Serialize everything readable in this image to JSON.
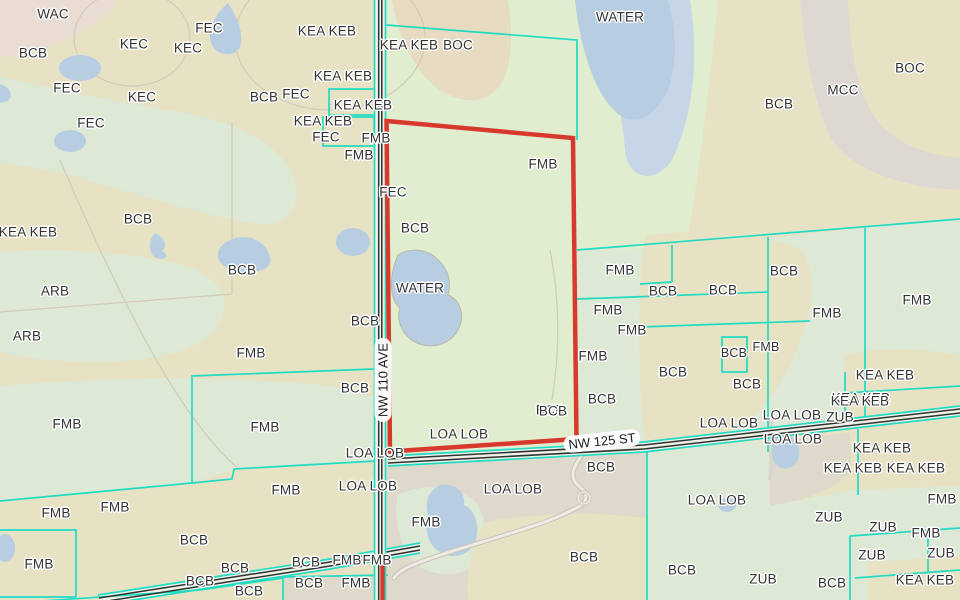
{
  "map": {
    "type": "soil-survey-map",
    "road_labels": [
      {
        "text": "NW 110 AVE",
        "x": 383,
        "y": 380,
        "rotation": -90
      },
      {
        "text": "NW 125 ST",
        "x": 602,
        "y": 441,
        "rotation": -6
      }
    ],
    "aoi": {
      "points": "386.5,121 573,138 576.5,439 390,451.5",
      "south_segment_d": "M382.5,562 L382.5,600"
    },
    "labels": [
      {
        "t": "WAC",
        "x": 53,
        "y": 14
      },
      {
        "t": "BCB",
        "x": 33,
        "y": 53
      },
      {
        "t": "KEC",
        "x": 134,
        "y": 44
      },
      {
        "t": "FEC",
        "x": 209,
        "y": 28
      },
      {
        "t": "KEC",
        "x": 188,
        "y": 48
      },
      {
        "t": "FEC",
        "x": 67,
        "y": 88
      },
      {
        "t": "KEC",
        "x": 142,
        "y": 97
      },
      {
        "t": "BCB",
        "x": 264,
        "y": 97
      },
      {
        "t": "FEC",
        "x": 296,
        "y": 94
      },
      {
        "t": "FEC",
        "x": 91,
        "y": 123
      },
      {
        "t": "KEA KEB",
        "x": 28,
        "y": 232
      },
      {
        "t": "BCB",
        "x": 138,
        "y": 219
      },
      {
        "t": "ARB",
        "x": 55,
        "y": 291
      },
      {
        "t": "ARB",
        "x": 27,
        "y": 336
      },
      {
        "t": "BCB",
        "x": 242,
        "y": 270
      },
      {
        "t": "FMB",
        "x": 251,
        "y": 353
      },
      {
        "t": "FMB",
        "x": 67,
        "y": 424
      },
      {
        "t": "KEA KEB",
        "x": 327,
        "y": 31
      },
      {
        "t": "KEA KEB",
        "x": 409,
        "y": 45
      },
      {
        "t": "BOC",
        "x": 458,
        "y": 45
      },
      {
        "t": "KEA KEB",
        "x": 343,
        "y": 76
      },
      {
        "t": "KEA KEB",
        "x": 363,
        "y": 105
      },
      {
        "t": "KEA KEB",
        "x": 323,
        "y": 121
      },
      {
        "t": "FEC",
        "x": 326,
        "y": 137
      },
      {
        "t": "FMB",
        "x": 376,
        "y": 138
      },
      {
        "t": "FMB",
        "x": 359,
        "y": 155
      },
      {
        "t": "FEC",
        "x": 393,
        "y": 192
      },
      {
        "t": "BCB",
        "x": 415,
        "y": 228
      },
      {
        "t": "FMB",
        "x": 543,
        "y": 164
      },
      {
        "t": "WATER",
        "x": 620,
        "y": 17
      },
      {
        "t": "BCB",
        "x": 779,
        "y": 104
      },
      {
        "t": "MCC",
        "x": 843,
        "y": 90
      },
      {
        "t": "BOC",
        "x": 910,
        "y": 68
      },
      {
        "t": "WATER",
        "x": 420,
        "y": 288
      },
      {
        "t": "BCB",
        "x": 365,
        "y": 321
      },
      {
        "t": "BCB",
        "x": 355,
        "y": 388
      },
      {
        "t": "FMB",
        "x": 620,
        "y": 270
      },
      {
        "t": "FMB",
        "x": 608,
        "y": 310
      },
      {
        "t": "FMB",
        "x": 632,
        "y": 330
      },
      {
        "t": "FMB",
        "x": 593,
        "y": 356
      },
      {
        "t": "BCB",
        "x": 602,
        "y": 399
      },
      {
        "t": "BCB",
        "x": 550,
        "y": 410
      },
      {
        "t": "BCB",
        "x": 663,
        "y": 291
      },
      {
        "t": "BCB",
        "x": 723,
        "y": 290
      },
      {
        "t": "BCB",
        "x": 784,
        "y": 271
      },
      {
        "t": "FMB",
        "x": 827,
        "y": 313
      },
      {
        "t": "FMB",
        "x": 917,
        "y": 300
      },
      {
        "t": "BCB",
        "x": 673,
        "y": 372
      },
      {
        "t": "BCB",
        "x": 734,
        "y": 353,
        "s": 12.5
      },
      {
        "t": "FMB",
        "x": 766,
        "y": 347,
        "s": 12.5
      },
      {
        "t": "BCB",
        "x": 747,
        "y": 384
      },
      {
        "t": "KEA KEB",
        "x": 885,
        "y": 375
      },
      {
        "t": "KEA KEB",
        "x": 861,
        "y": 398
      },
      {
        "t": "LOA LOB",
        "x": 459,
        "y": 434
      },
      {
        "t": "LOA LOB",
        "x": 375,
        "y": 453
      },
      {
        "t": "LOA LOB",
        "x": 368,
        "y": 486
      },
      {
        "t": "LOA LOB",
        "x": 513,
        "y": 489
      },
      {
        "t": "BCB",
        "x": 553,
        "y": 411
      },
      {
        "t": "BCB",
        "x": 601,
        "y": 467
      },
      {
        "t": "BCB",
        "x": 584,
        "y": 557
      },
      {
        "t": "FMB",
        "x": 426,
        "y": 522
      },
      {
        "t": "FMB",
        "x": 347,
        "y": 560
      },
      {
        "t": "FMB",
        "x": 377,
        "y": 560
      },
      {
        "t": "FMB",
        "x": 356,
        "y": 583
      },
      {
        "t": "FMB",
        "x": 286,
        "y": 490
      },
      {
        "t": "FMB",
        "x": 115,
        "y": 507
      },
      {
        "t": "FMB",
        "x": 56,
        "y": 513
      },
      {
        "t": "FMB",
        "x": 39,
        "y": 564
      },
      {
        "t": "FMB",
        "x": 265,
        "y": 427
      },
      {
        "t": "BCB",
        "x": 194,
        "y": 540
      },
      {
        "t": "BCB",
        "x": 235,
        "y": 568
      },
      {
        "t": "BCB",
        "x": 200,
        "y": 581
      },
      {
        "t": "BCB",
        "x": 306,
        "y": 562
      },
      {
        "t": "BCB",
        "x": 309,
        "y": 583
      },
      {
        "t": "BCB",
        "x": 249,
        "y": 591
      },
      {
        "t": "KEA KEB",
        "x": 860,
        "y": 401
      },
      {
        "t": "LOA LOB",
        "x": 729,
        "y": 423
      },
      {
        "t": "LOA LOB",
        "x": 792,
        "y": 415
      },
      {
        "t": "ZUB",
        "x": 840,
        "y": 417
      },
      {
        "t": "LOA LOB",
        "x": 793,
        "y": 439
      },
      {
        "t": "KEA KEB",
        "x": 882,
        "y": 448
      },
      {
        "t": "KEA KEB",
        "x": 853,
        "y": 468
      },
      {
        "t": "KEA KEB",
        "x": 916,
        "y": 468
      },
      {
        "t": "FMB",
        "x": 942,
        "y": 499
      },
      {
        "t": "LOA LOB",
        "x": 717,
        "y": 500
      },
      {
        "t": "ZUB",
        "x": 829,
        "y": 517
      },
      {
        "t": "ZUB",
        "x": 883,
        "y": 527
      },
      {
        "t": "FMB",
        "x": 926,
        "y": 533
      },
      {
        "t": "ZUB",
        "x": 872,
        "y": 555
      },
      {
        "t": "ZUB",
        "x": 941,
        "y": 553
      },
      {
        "t": "BCB",
        "x": 682,
        "y": 570
      },
      {
        "t": "ZUB",
        "x": 763,
        "y": 579
      },
      {
        "t": "BCB",
        "x": 832,
        "y": 583
      },
      {
        "t": "KEA KEB",
        "x": 925,
        "y": 580
      }
    ]
  },
  "colors": {
    "tan": "#e8e2c4",
    "tandark": "#e7dbc2",
    "pink": "#e9dcd2",
    "sage": "#dde8d5",
    "aoigreen": "#e0edcf",
    "graytan": "#ded9cb",
    "mcc": "#ded8d2",
    "water": "#b7cde2",
    "water2": "#c6d6e6",
    "teal": "#1fdcc3",
    "red": "#d73a2d",
    "roaddark": "#2c3530",
    "labeltext": "#333333"
  }
}
